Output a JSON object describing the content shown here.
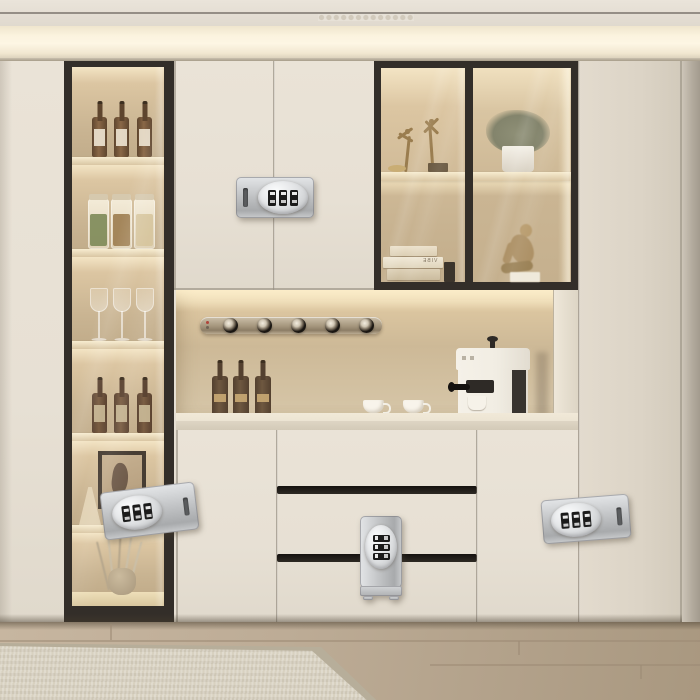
{
  "meta": {
    "type": "interior-photograph",
    "subject": "Cream built-in wall cabinet with lit glass display shelves, coffee niche and four silver 3-dial combination safety locks installed on doors and drawers"
  },
  "colors": {
    "wall": "#e6dfd3",
    "ceiling": "#eae4da",
    "cove": "#fdf6e4",
    "door": "#e7e0d4",
    "door_dark": "#dcd4c6",
    "frame": "#332e29",
    "interior": "#c9b492",
    "interior_glow": "#f3e4c4",
    "shelf": "#d9c6a3",
    "counter": "#ece4d3",
    "niche": "#cdb997",
    "lock": "#c2c4c6",
    "dial": "#1b1b1b",
    "floor": "#bdac96",
    "rug": "#d8d1c0",
    "plant": "#8f9077",
    "bronze": "#9a7d4f"
  },
  "left_display_column": {
    "shelves": [
      {
        "name": "wine-bottles",
        "count": 3
      },
      {
        "name": "storage-jars",
        "count": 3
      },
      {
        "name": "wine-glasses",
        "count": 3
      },
      {
        "name": "wine-bottles",
        "count": 3
      },
      {
        "name": "framed-artwork-with-flasks",
        "count": 1
      },
      {
        "name": "dried-branches-in-vase",
        "count": 1
      }
    ]
  },
  "upper_glass_cabinet": {
    "left_pane": {
      "top": "two bronze dancer figurines with trinket dish",
      "books_count": 3,
      "books_spine_text": "VIBE"
    },
    "right_pane": {
      "top": "potted plant in white pot",
      "bottom": "seated figure sculpture"
    }
  },
  "niche": {
    "rail_knob_count": 5,
    "wine_bottles": 3,
    "espresso_cups": 2,
    "appliance": "espresso machine"
  },
  "locks": [
    {
      "id": "upper-center",
      "orientation": "horizontal",
      "dials": 3
    },
    {
      "id": "lower-left",
      "orientation": "horizontal",
      "dials": 3
    },
    {
      "id": "lower-center",
      "orientation": "vertical",
      "dials": 3
    },
    {
      "id": "lower-right",
      "orientation": "horizontal",
      "dials": 3
    }
  ],
  "floor": {
    "material": "light wood planks",
    "rug": "beige woven rug"
  }
}
